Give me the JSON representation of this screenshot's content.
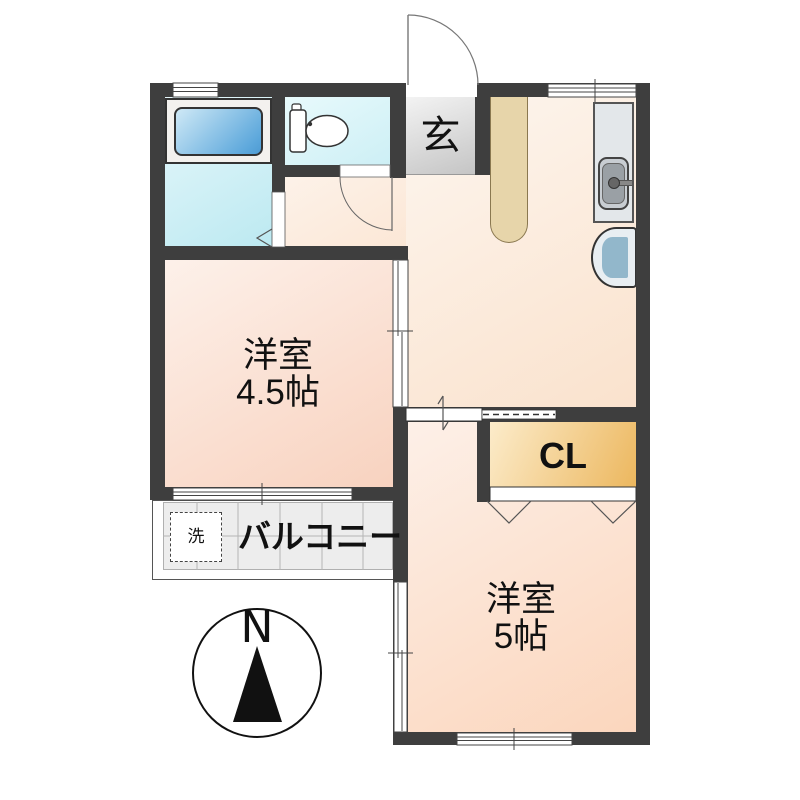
{
  "plan": {
    "type": "apartment-floor-plan",
    "compass": {
      "label": "N"
    },
    "entrance": {
      "label": "玄"
    },
    "rooms": [
      {
        "id": "western-room-1",
        "name": "洋室",
        "size": "4.5帖"
      },
      {
        "id": "western-room-2",
        "name": "洋室",
        "size": "5帖"
      }
    ],
    "closet": {
      "label": "CL"
    },
    "balcony": {
      "label": "バルコニー"
    },
    "washer": {
      "label": "洗"
    },
    "fixtures": [
      "bathtub",
      "toilet",
      "kitchen-sink",
      "refrigerator",
      "counter",
      "washing-machine-space"
    ],
    "colors": {
      "wall": "#3e3e3e",
      "text": "#111111",
      "room_peach_light": "#fdf1ea",
      "room_peach_dark": "#f8d2bf",
      "bath_cyan_light": "#e7f8fb",
      "bath_cyan_dark": "#bce9f1",
      "tub_blue": "#4e9bd3",
      "genkan_gray": "#c5c5c5",
      "closet_orange": "#ecb75e",
      "counter_tan": "#e7d5aa",
      "balcony_tile": "#ededed"
    }
  }
}
